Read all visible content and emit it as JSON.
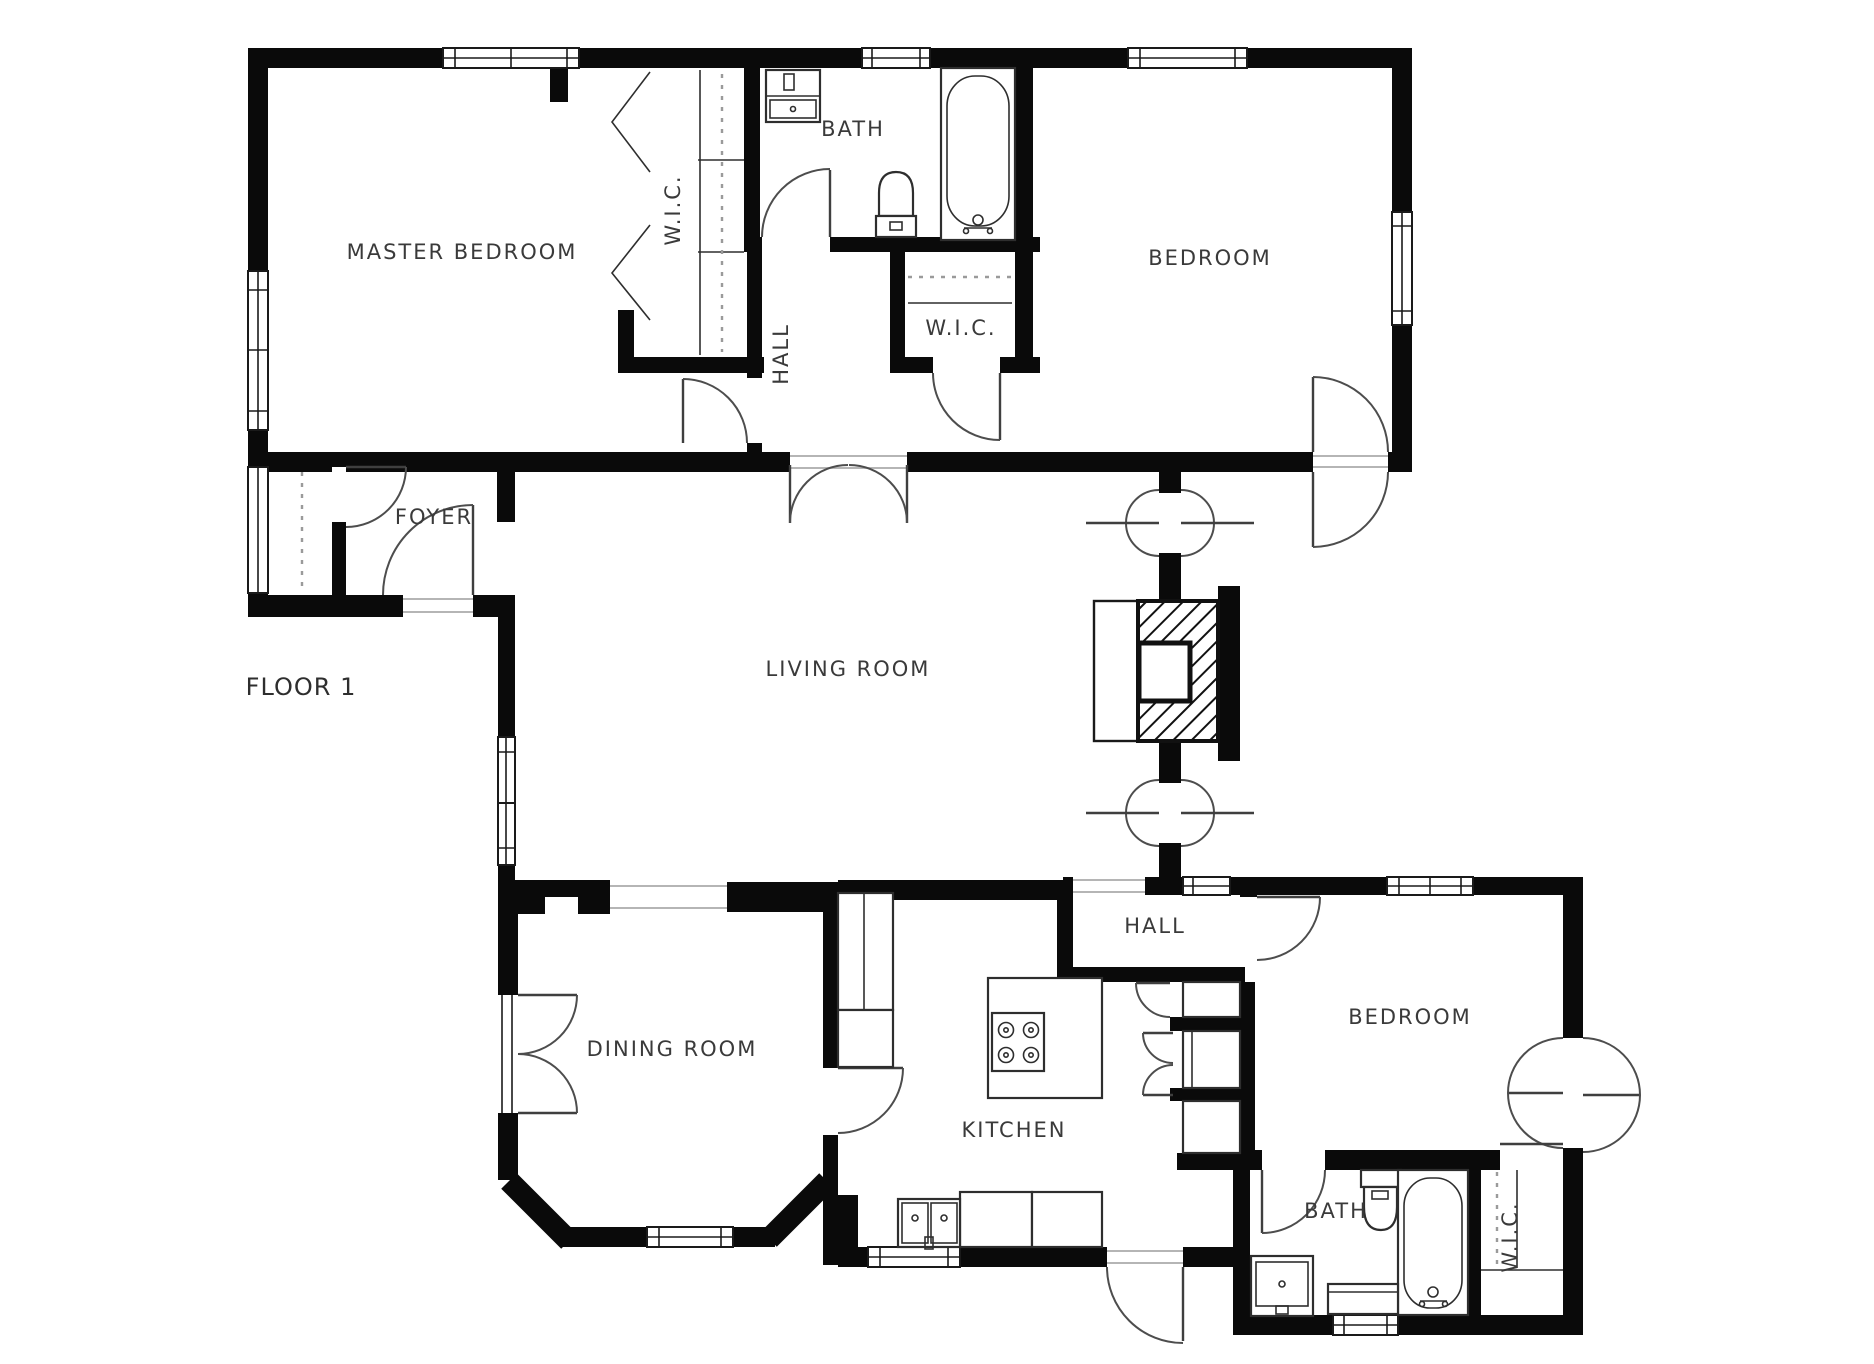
{
  "title": "FLOOR 1",
  "colors": {
    "wall": "#0a0a0a",
    "background": "#ffffff",
    "door_line": "#4d4d4d",
    "label": "#3a3a3a"
  },
  "rooms": [
    {
      "id": "master-bedroom",
      "label": "MASTER BEDROOM"
    },
    {
      "id": "wic-master",
      "label": "W.I.C."
    },
    {
      "id": "bath-upper",
      "label": "BATH"
    },
    {
      "id": "hall-upper",
      "label": "HALL"
    },
    {
      "id": "wic-upper",
      "label": "W.I.C."
    },
    {
      "id": "bedroom-upper",
      "label": "BEDROOM"
    },
    {
      "id": "foyer",
      "label": "FOYER"
    },
    {
      "id": "living-room",
      "label": "LIVING ROOM"
    },
    {
      "id": "dining-room",
      "label": "DINING ROOM"
    },
    {
      "id": "kitchen",
      "label": "KITCHEN"
    },
    {
      "id": "hall-lower",
      "label": "HALL"
    },
    {
      "id": "bedroom-lower",
      "label": "BEDROOM"
    },
    {
      "id": "bath-lower",
      "label": "BATH"
    },
    {
      "id": "wic-lower",
      "label": "W.I.C."
    }
  ],
  "fixtures": [
    "bathtub",
    "toilet",
    "sink-vanity",
    "kitchen-sink",
    "stove",
    "kitchen-island",
    "fireplace",
    "closet-rod",
    "bifold-doors",
    "counters"
  ]
}
